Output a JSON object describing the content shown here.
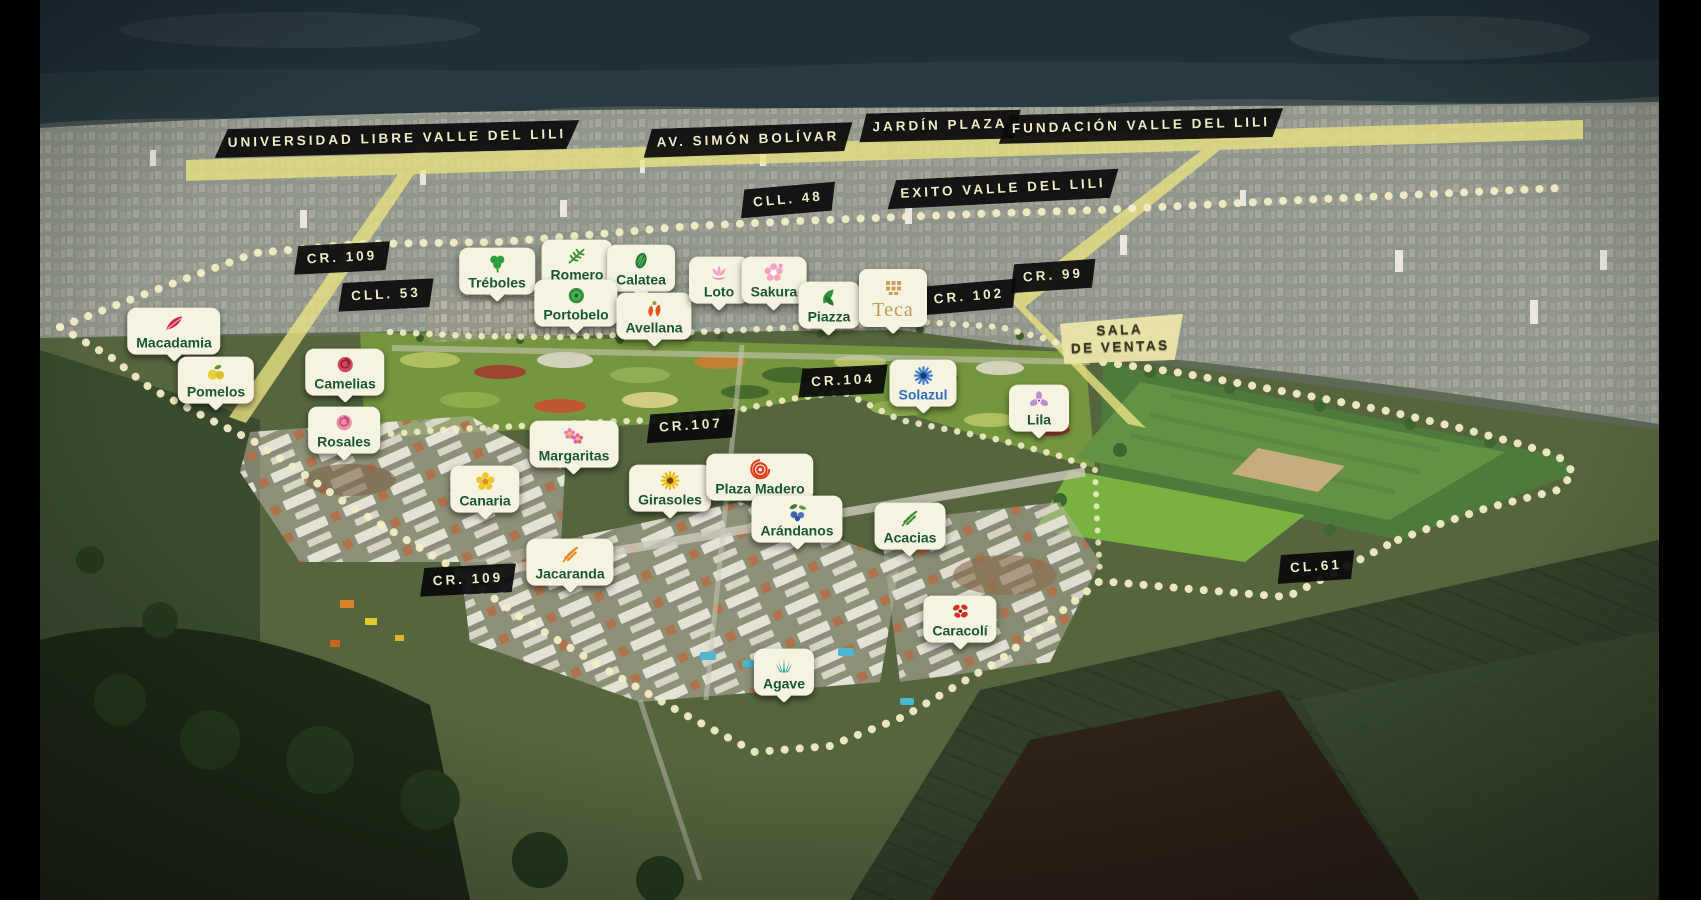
{
  "map_title": "Aerial masterplan - Valle del Lili residential development",
  "colors": {
    "badge_bg": "#f6f3e1",
    "badge_text_green": "#175736",
    "badge_text_blue": "#2e6fc0",
    "teca_gold": "#bb9a5e",
    "ribbon_bg": "#0a0a0a",
    "ribbon_text": "#f1ebc8",
    "sala_bg": "#ece5a9",
    "sala_text": "#3c3823",
    "boundary_dots": "#f2edc5",
    "road_band": "#eae483"
  },
  "road_labels": [
    {
      "id": "universidad-libre",
      "label": "UNIVERSIDAD LIBRE VALLE DEL LILI",
      "x": 397,
      "y": 139,
      "rot": -1.5,
      "variant": "dark"
    },
    {
      "id": "av-simon-bolivar",
      "label": "AV. SIMÓN BOLÍVAR",
      "x": 748,
      "y": 140,
      "rot": -2,
      "variant": "dark"
    },
    {
      "id": "jardin-plaza",
      "label": "JARDÍN PLAZA",
      "x": 940,
      "y": 126,
      "rot": -1.5,
      "variant": "dark"
    },
    {
      "id": "fundacion-valle-del-lili",
      "label": "FUNDACIÓN VALLE DEL LILI",
      "x": 1141,
      "y": 126,
      "rot": -1.5,
      "variant": "dark"
    },
    {
      "id": "cll-48",
      "label": "CLL. 48",
      "x": 788,
      "y": 200,
      "rot": -5,
      "variant": "dark"
    },
    {
      "id": "exito-valle-del-lili",
      "label": "EXITO VALLE DEL LILI",
      "x": 1003,
      "y": 189,
      "rot": -3,
      "variant": "dark"
    },
    {
      "id": "cr-109-norte",
      "label": "CR. 109",
      "x": 342,
      "y": 258,
      "rot": -3,
      "variant": "dark"
    },
    {
      "id": "cll-53",
      "label": "CLL. 53",
      "x": 386,
      "y": 295,
      "rot": -3,
      "variant": "dark"
    },
    {
      "id": "cr-99",
      "label": "CR. 99",
      "x": 1053,
      "y": 276,
      "rot": -4,
      "variant": "dark"
    },
    {
      "id": "cr-102",
      "label": "CR. 102",
      "x": 969,
      "y": 297,
      "rot": -5,
      "variant": "dark"
    },
    {
      "id": "cr-104",
      "label": "CR.104",
      "x": 843,
      "y": 381,
      "rot": -3,
      "variant": "dark"
    },
    {
      "id": "cr-107",
      "label": "CR.107",
      "x": 691,
      "y": 426,
      "rot": -4,
      "variant": "dark"
    },
    {
      "id": "cr-109-sur",
      "label": "CR. 109",
      "x": 468,
      "y": 580,
      "rot": -3,
      "variant": "dark"
    },
    {
      "id": "cl-61",
      "label": "CL.61",
      "x": 1316,
      "y": 567,
      "rot": -4,
      "variant": "dark"
    },
    {
      "id": "sala-de-ventas",
      "label": "SALA\nDE VENTAS",
      "x": 1120,
      "y": 339,
      "rot": -2,
      "variant": "cream"
    }
  ],
  "project_markers": [
    {
      "id": "treboles",
      "name": "Tréboles",
      "icon": "clover-icon",
      "x": 497,
      "y": 271
    },
    {
      "id": "romero",
      "name": "Romero",
      "icon": "rosemary-sprig-icon",
      "x": 577,
      "y": 263
    },
    {
      "id": "calatea",
      "name": "Calatea",
      "icon": "calathea-leaf-icon",
      "x": 641,
      "y": 268
    },
    {
      "id": "portobelo",
      "name": "Portobelo",
      "icon": "portobello-icon",
      "x": 576,
      "y": 303
    },
    {
      "id": "avellana",
      "name": "Avellana",
      "icon": "hazelnut-icon",
      "x": 654,
      "y": 316
    },
    {
      "id": "loto",
      "name": "Loto",
      "icon": "lotus-icon",
      "x": 719,
      "y": 280
    },
    {
      "id": "sakura",
      "name": "Sakura",
      "icon": "cherry-blossom-icon",
      "x": 774,
      "y": 280
    },
    {
      "id": "piazza",
      "name": "Piazza",
      "icon": "leaf-swirl-icon",
      "x": 829,
      "y": 305
    },
    {
      "id": "teca",
      "name": "Teca",
      "icon": "teca-emblem-icon",
      "x": 893,
      "y": 298,
      "variant": "logo"
    },
    {
      "id": "macadamia",
      "name": "Macadamia",
      "icon": "macadamia-feather-icon",
      "x": 174,
      "y": 331
    },
    {
      "id": "pomelos",
      "name": "Pomelos",
      "icon": "pomelo-icon",
      "x": 216,
      "y": 380
    },
    {
      "id": "camelias",
      "name": "Camelias",
      "icon": "camellia-rose-icon",
      "x": 345,
      "y": 372
    },
    {
      "id": "rosales",
      "name": "Rosales",
      "icon": "rose-icon",
      "x": 344,
      "y": 430
    },
    {
      "id": "margaritas",
      "name": "Margaritas",
      "icon": "daisies-icon",
      "x": 574,
      "y": 444
    },
    {
      "id": "solazul",
      "name": "Solazul",
      "icon": "blue-flower-icon",
      "x": 923,
      "y": 383,
      "text_color": "#2e6fc0"
    },
    {
      "id": "lila",
      "name": "Lila",
      "icon": "lilac-flower-icon",
      "x": 1039,
      "y": 408
    },
    {
      "id": "canaria",
      "name": "Canaria",
      "icon": "yellow-flower-icon",
      "x": 485,
      "y": 489
    },
    {
      "id": "girasoles",
      "name": "Girasoles",
      "icon": "sunflower-icon",
      "x": 670,
      "y": 488
    },
    {
      "id": "plaza-madero",
      "name": "Plaza Madero",
      "icon": "spiral-rings-icon",
      "x": 760,
      "y": 477
    },
    {
      "id": "arandanos",
      "name": "Arándanos",
      "icon": "blueberries-icon",
      "x": 797,
      "y": 519
    },
    {
      "id": "acacias",
      "name": "Acacias",
      "icon": "acacia-leaves-icon",
      "x": 910,
      "y": 526
    },
    {
      "id": "jacaranda",
      "name": "Jacaranda",
      "icon": "jacaranda-leaf-icon",
      "x": 570,
      "y": 562
    },
    {
      "id": "caracoli",
      "name": "Caracolí",
      "icon": "caracoli-flower-icon",
      "x": 960,
      "y": 619
    },
    {
      "id": "agave",
      "name": "Agave",
      "icon": "agave-icon",
      "x": 784,
      "y": 672
    }
  ]
}
